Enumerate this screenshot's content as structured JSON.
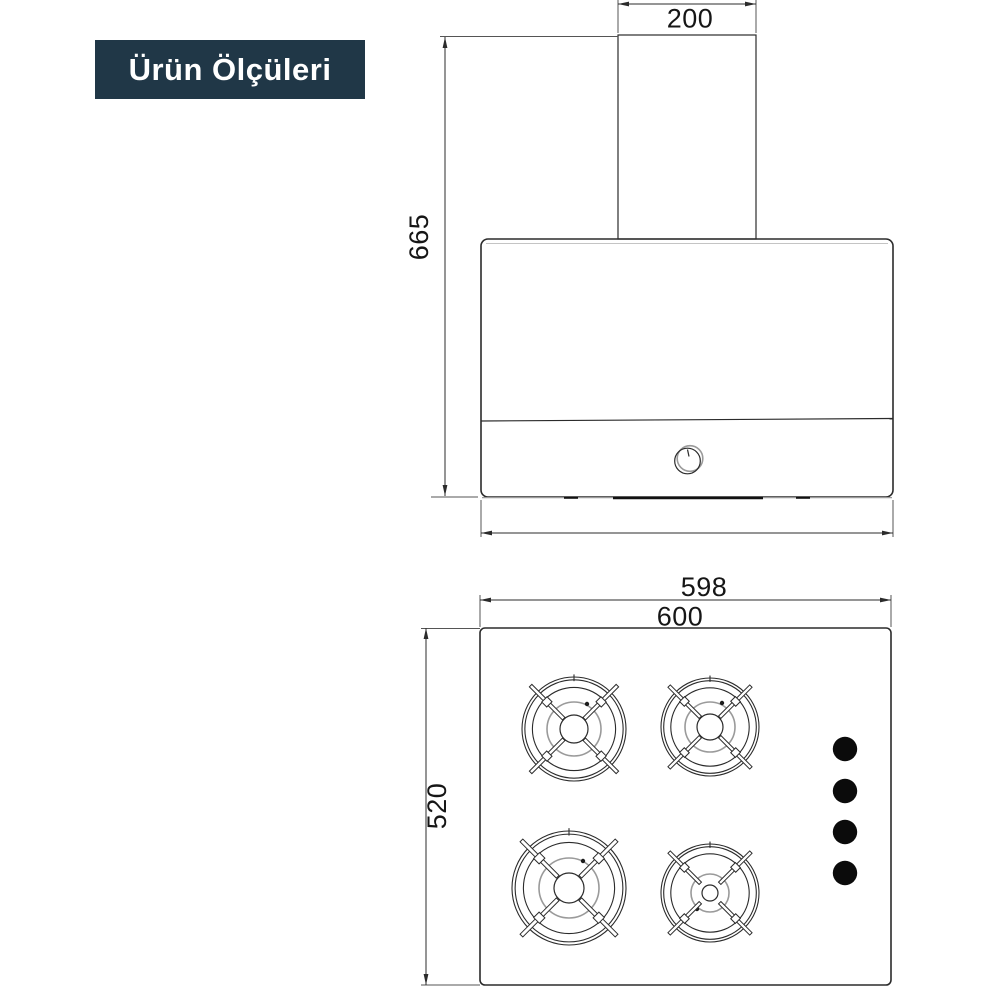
{
  "badge": {
    "label": "Ürün Ölçüleri"
  },
  "colors": {
    "badge_bg": "#203747",
    "badge_text": "#ffffff",
    "line_ink": "#2b2b2b",
    "line_gray": "#9a9a9a",
    "knob_fill": "#0b0b0b"
  },
  "hood": {
    "labels": {
      "chimney_width": "200",
      "total_height": "665"
    }
  },
  "hob": {
    "labels": {
      "glass_width": "598",
      "total_width": "600",
      "depth": "520"
    }
  }
}
